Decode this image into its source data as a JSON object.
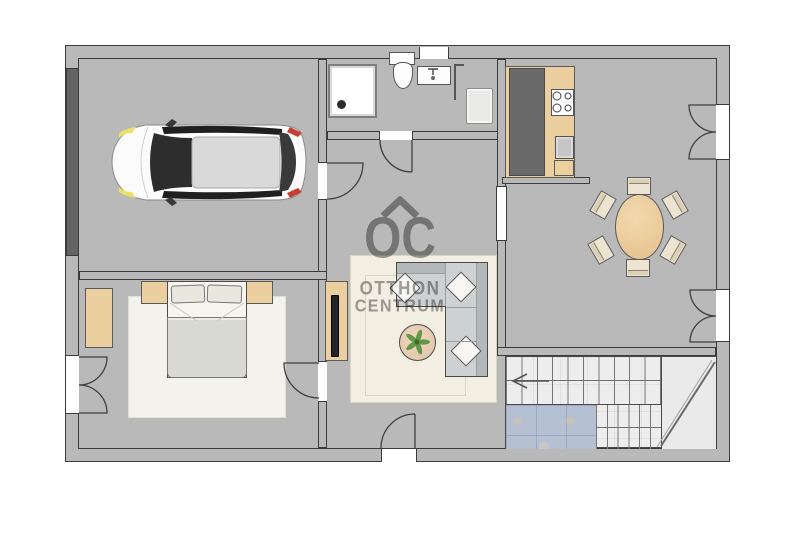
{
  "watermark": {
    "logo": "OC",
    "line1": "OTTHON",
    "line2": "CENTRUM",
    "roof_icon": "chevron-roof",
    "color": "#8b8b8b"
  },
  "stairs": {
    "direction_icon": "arrow-left"
  },
  "palette": {
    "wall": "#b9b9b9",
    "wall_outline": "#3c3c3c",
    "garage_floor": "#d8c6a4",
    "bathroom_floor": "#e7d3b0",
    "bedroom_floor": "#ecd9ad",
    "living_floor": "#b5c0d2",
    "kitchen_floor": "#f3f5f9",
    "stair_floor": "#ededed",
    "counter_top": "#6a6a6a",
    "wood_furniture": "#eccf9f",
    "sofa": "#cdd1d1",
    "dining_table": "#e5c08b",
    "car_front_light": "#e9e268",
    "car_tail_light": "#c44034",
    "plant": "#5d9440"
  }
}
